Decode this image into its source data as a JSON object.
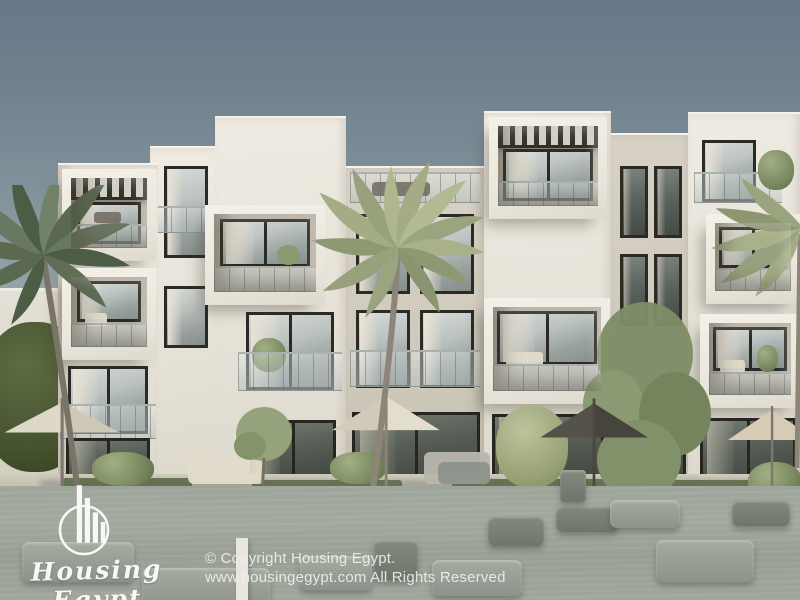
{
  "watermark": {
    "brand": "Housing Egypt",
    "logo_icon": "highrise-buildings-in-circle-icon"
  },
  "footer": {
    "copyright_line": "© Copyright Housing Egypt.",
    "rights_line": "www.housingegypt.com All Rights Reserved"
  },
  "palette": {
    "sky_top": "#66788a",
    "sky_horizon": "#cdd1ca",
    "facade_sunlit": "#ece8df",
    "facade_shaded": "#cfc9bc",
    "window_frame": "#2b2a25",
    "glass": "#aab3b0",
    "pergola_slats": "#34332d",
    "palm_light": "#a3ac85",
    "palm_dark": "#5a694f",
    "foliage": "#7b8a60",
    "foreground_water": "#a0a69c",
    "umbrella_cream": "#ded8c8",
    "umbrella_dark": "#55524a",
    "umbrella_tan": "#d6ccb6",
    "furniture_gray": "#959b93",
    "watermark_text": "#fbfcfa",
    "footer_text": "#ecf0ed"
  }
}
